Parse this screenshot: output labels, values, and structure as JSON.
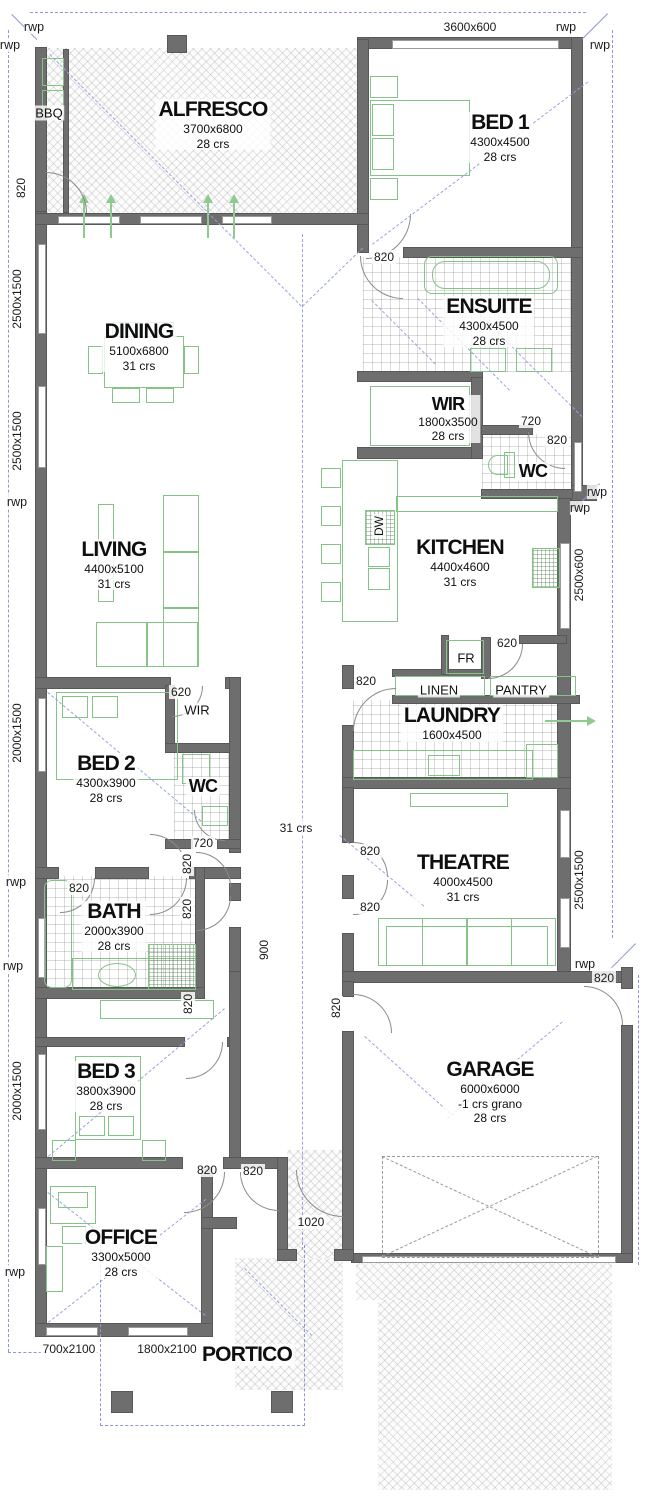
{
  "rooms": [
    {
      "name": "ALFRESCO",
      "dims": "3700x6800",
      "crs": "28 crs"
    },
    {
      "name": "BED 1",
      "dims": "4300x4500",
      "crs": "28 crs"
    },
    {
      "name": "DINING",
      "dims": "5100x6800",
      "crs": "31 crs"
    },
    {
      "name": "ENSUITE",
      "dims": "4300x4500",
      "crs": "28 crs"
    },
    {
      "name": "WIR",
      "dims": "1800x3500",
      "crs": "28 crs"
    },
    {
      "name": "WC"
    },
    {
      "name": "LIVING",
      "dims": "4400x5100",
      "crs": "31 crs"
    },
    {
      "name": "KITCHEN",
      "dims": "4400x4600",
      "crs": "31 crs"
    },
    {
      "name": "LAUNDRY",
      "dims": "1600x4500"
    },
    {
      "name": "BED 2",
      "dims": "4300x3900",
      "crs": "28 crs"
    },
    {
      "name": "WIR"
    },
    {
      "name": "WC"
    },
    {
      "name": "BATH",
      "dims": "2000x3900",
      "crs": "28 crs"
    },
    {
      "name": "THEATRE",
      "dims": "4000x4500",
      "crs": "31 crs"
    },
    {
      "name": "BED 3",
      "dims": "3800x3900",
      "crs": "28 crs"
    },
    {
      "name": "GARAGE",
      "dims": "6000x6000",
      "note": "-1 crs grano",
      "crs": "28 crs"
    },
    {
      "name": "OFFICE",
      "dims": "3300x5000",
      "crs": "28 crs"
    },
    {
      "name": "PORTICO"
    }
  ],
  "fixtures": {
    "bbq": "BBQ",
    "dw": "DW",
    "fr": "FR",
    "linen": "LINEN",
    "pantry": "PANTRY"
  },
  "dims": {
    "bed1_window": "3600x600",
    "alfresco_door": "820",
    "left_window_1": "2500x1500",
    "left_window_2": "2500x1500",
    "left_window_3": "2000x1500",
    "left_window_4": "2000x1500",
    "right_window_kitchen": "2500x600",
    "right_window_theatre": "2500x1500",
    "ensuite_door": "820",
    "wc1_door": "720",
    "wc1_window": "820",
    "pantry_door": "620",
    "laundry_door": "820",
    "wir2_door": "620",
    "wc2_door": "720",
    "hall_door_a": "820",
    "hall_door_b": "820",
    "bath_door": "820",
    "theatre_door_a": "820",
    "theatre_door_b": "820",
    "hall_height": "31 crs",
    "hall_width": "900",
    "bed3_hall_door": "820",
    "garage_hall_door": "820",
    "garage_rear_door": "820",
    "bed3_door": "820",
    "office_door": "820",
    "entry_door": "1020",
    "office_window_1": "700x2100",
    "office_window_2": "1800x2100"
  },
  "rwp_label": "rwp"
}
